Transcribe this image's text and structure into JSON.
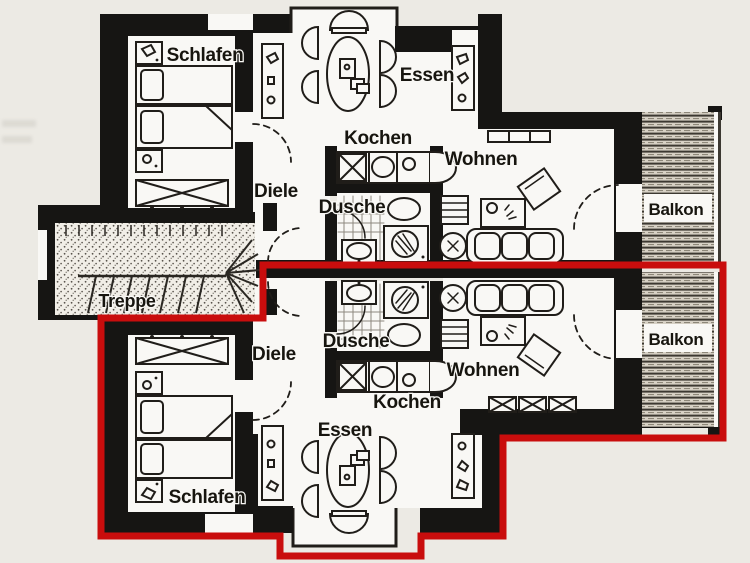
{
  "colors": {
    "highlight_red": "#c90d0d",
    "walls": "#161513",
    "paper": "#eceae4",
    "floor": "#f9f8f5"
  },
  "floorplan": {
    "stairwell": {
      "label": "Treppe"
    },
    "upper": {
      "schlafen": "Schlafen",
      "essen": "Essen",
      "kochen": "Kochen",
      "diele": "Diele",
      "dusche": "Dusche",
      "wohnen": "Wohnen",
      "balkon": "Balkon"
    },
    "lower": {
      "schlafen": "Schlafen",
      "essen": "Essen",
      "kochen": "Kochen",
      "diele": "Diele",
      "dusche": "Dusche",
      "wohnen": "Wohnen",
      "balkon": "Balkon"
    }
  }
}
